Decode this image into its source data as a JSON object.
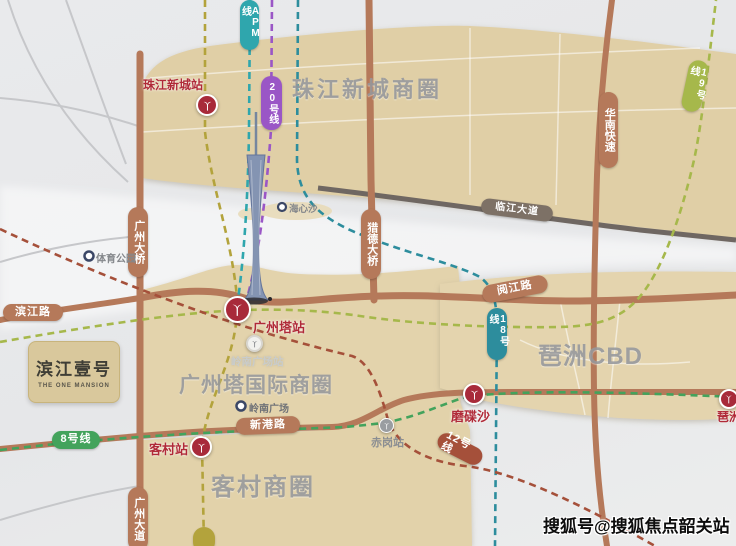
{
  "districts": {
    "zhujiang": "珠江新城商圈",
    "gta": "广州塔国际商圈",
    "pazhou": "琶洲CBD",
    "kecun": "客村商圈"
  },
  "stations": {
    "zhujiangxincheng": "珠江新城站",
    "guangzhouta": "广州塔站",
    "kecun": "客村站",
    "modiesha": "磨碟沙",
    "pazhou": "琶洲",
    "chigang": "赤岗站",
    "lingnan": "岭南广场站"
  },
  "pois": {
    "sports_park": "体育公园",
    "haixinsha": "海心沙",
    "lingnan_square": "岭南广场"
  },
  "roads": {
    "guangzhou_bridge": "广州大桥",
    "binjiang_road": "滨江路",
    "guangzhou_avenue": "广州大道",
    "xingang_road": "新港路",
    "yuejiang_road": "阅江路",
    "huanan_expressway": "华南快速",
    "linjiang_avenue": "临江大道",
    "liede_bridge": "猎德大桥"
  },
  "metro": {
    "apm": {
      "label": "APM线",
      "color": "#2fa6ad"
    },
    "line20": {
      "label": "20号线",
      "color": "#9a56c6"
    },
    "line18": {
      "label": "18号线",
      "color": "#2d8d9d"
    },
    "line19": {
      "label": "19号线",
      "color": "#a6b84b"
    },
    "line8": {
      "label": "8号线",
      "color": "#43a35c"
    },
    "line12": {
      "label": "12号线",
      "color": "#a5503a"
    },
    "line3": {
      "color": "#b3a33c"
    }
  },
  "project": {
    "name": "滨江壹号",
    "name_en": "THE ONE MANSION"
  },
  "watermark": "搜狐号@搜狐焦点韶关站",
  "colors": {
    "road": "#b5795a",
    "road_dark": "#7d7166",
    "station_red": "#a82a3a",
    "station_gray": "#9a9da1",
    "district_tan": "#e2d1a9"
  }
}
